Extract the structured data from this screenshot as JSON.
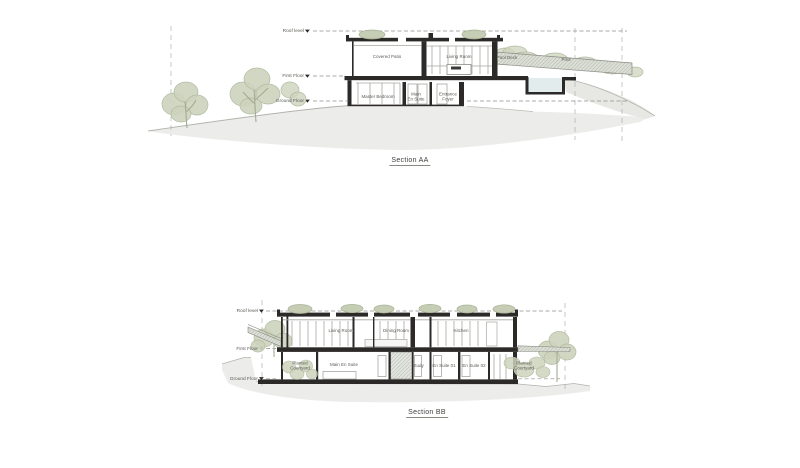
{
  "drawing": {
    "section_aa": {
      "title": "Section AA",
      "levels": {
        "roof": "Roof level",
        "first": "First Floor",
        "ground": "Ground Floor"
      },
      "rooms": {
        "covered_patio": "Covered Patio",
        "living_room": "Living Room",
        "pool_deck": "Pool Deck",
        "pool": "Pool",
        "master_bedroom": "Master Bedroom",
        "main_en_suite": "Main\nEn Suite",
        "entrance_foyer": "Entrance\nFoyer"
      }
    },
    "section_bb": {
      "title": "Section BB",
      "levels": {
        "roof": "Roof level",
        "first": "First Floor",
        "ground": "Ground Floor"
      },
      "rooms": {
        "living_room": "Living Room",
        "dining_room": "Dining Room",
        "kitchen": "Kitchen",
        "planted_courtyard_left": "Planted\nCourtyard",
        "main_en_suite": "Main En Suite",
        "study": "Study",
        "en_suite_01": "En Suite 01",
        "en_suite_02": "En Suite 02",
        "planted_courtyard_right": "Planted\nCourtyard"
      }
    },
    "colors": {
      "paper": "#ffffff",
      "cut_structure": "#2b2a28",
      "terrain": "#ececea",
      "foliage": "#ccd3bc",
      "foliage_line": "#b2bca2",
      "water": "#e2ecec",
      "linework": "#9a9a94",
      "text": "#5a5a55"
    }
  }
}
